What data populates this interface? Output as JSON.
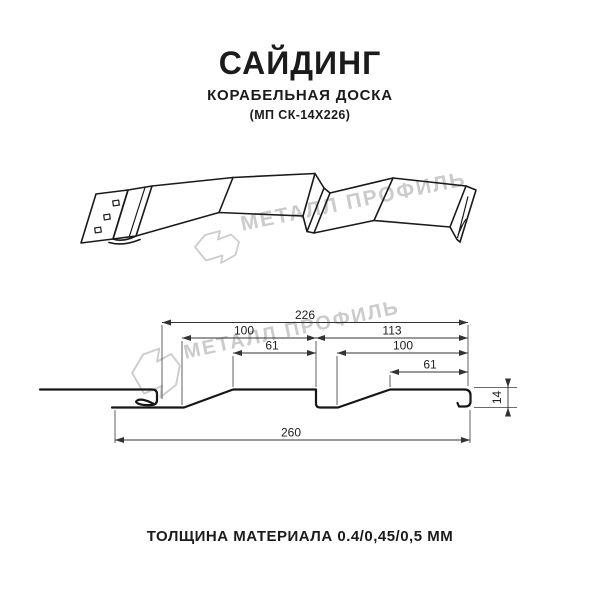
{
  "meta": {
    "background": "#ffffff",
    "line_color": "#1a1a1a",
    "dim_line_color": "#333333",
    "watermark_color": "#cbcbcb",
    "text_color": "#1b1b1b"
  },
  "header": {
    "title": "САЙДИНГ",
    "subtitle": "КОРАБЕЛЬНАЯ ДОСКА",
    "code": "(МП СК-14Х226)"
  },
  "watermark": {
    "text": "МЕТАЛЛ ПРОФИЛЬ",
    "logo_icon": "metall-profil-logo"
  },
  "tech": {
    "dims": {
      "d226": "226",
      "d100_left": "100",
      "d61_left": "61",
      "d113": "113",
      "d100_right": "100",
      "d61_right": "61",
      "d260": "260",
      "d14": "14"
    }
  },
  "footer": {
    "thickness_label": "ТОЛЩИНА МАТЕРИАЛА 0.4/0,45/0,5 ММ"
  }
}
